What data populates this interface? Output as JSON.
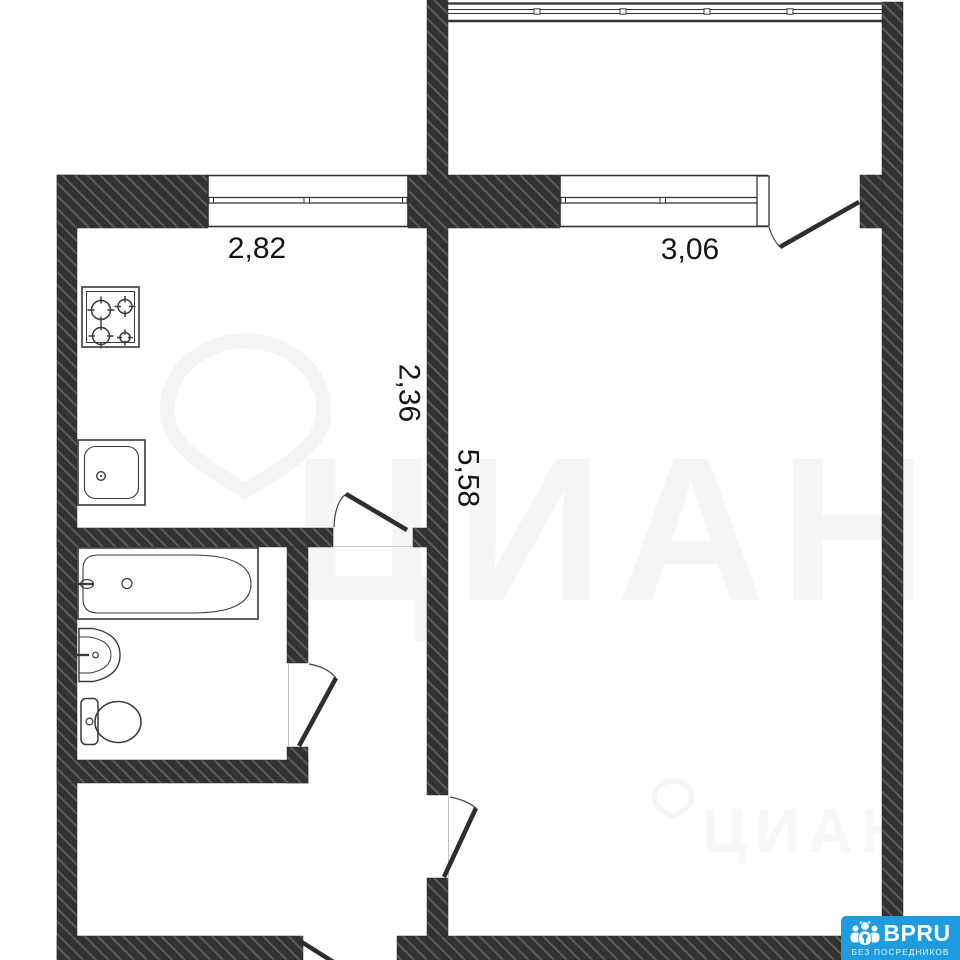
{
  "plan": {
    "dimensions": {
      "kitchen_width": "2,82",
      "living_room_width": "3,06",
      "kitchen_depth": "2,36",
      "living_room_depth": "5,58"
    },
    "fixtures": [
      "stove-icon",
      "kitchen-sink-icon",
      "bathtub-icon",
      "washbasin-icon",
      "toilet-icon"
    ]
  },
  "watermark": {
    "brand": "ЦИАН"
  },
  "logo": {
    "name": "BPRU",
    "tagline": "БЕЗ ПОСРЕДНИКОВ",
    "background_color": "#1e9ce0"
  },
  "colors": {
    "wall": "#333333",
    "lines": "#333333",
    "background": "#ffffff"
  }
}
